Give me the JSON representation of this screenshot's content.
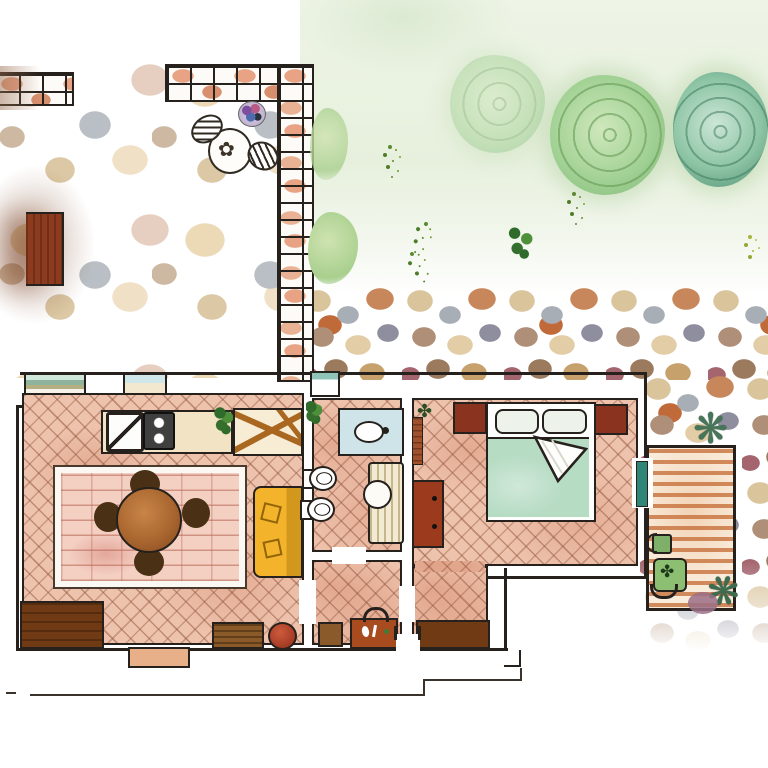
{
  "meta": {
    "title": "Watercolor floor plan of an apartment with garden, stone courtyard and wooden terrace",
    "type": "hand-painted illustration, no text in image",
    "canvas_px": {
      "width": 768,
      "height": 768
    }
  },
  "palette": {
    "paper": "#ffffff",
    "ink": "#26211c",
    "floor_terracotta": "#eec3ad",
    "floor_joint_line": "#92543c",
    "rug_pink": "#f4d0c3",
    "brick_wall_salmon": "#e8a284",
    "garden_wash_green": "#e7f0dd",
    "bush_green": "#a3d295",
    "bush_teal": "#8cc4a4",
    "bed_duvet_green": "#b7dcc4",
    "sofa_yellow": "#f3b32a",
    "wood_dark_brown": "#6f3a14",
    "wood_red_brown": "#9c3a1e",
    "deck_plank_orange": "#c86e38",
    "door_teal": "#2f8577",
    "basin_blue": "#cfe4e9",
    "counter_cream": "#f2e3c4",
    "stone_gray": "#a8aeb6",
    "stone_tan": "#d9c49c",
    "clay_pot_red": "#b5402a"
  },
  "scene": {
    "exterior": {
      "areas": [
        {
          "name": "garden-lawn",
          "position": "top-right"
        },
        {
          "name": "stone-path",
          "position": "center-right band"
        },
        {
          "name": "stone-courtyard",
          "position": "top-left"
        },
        {
          "name": "right-pebble-yard",
          "position": "around terrace"
        }
      ],
      "garden_plants": [
        {
          "name": "rose-bush-faint"
        },
        {
          "name": "rose-bush-large"
        },
        {
          "name": "rose-bush-teal"
        },
        {
          "name": "grass-tuft",
          "count": 5
        },
        {
          "name": "wall-climber-leaves",
          "count": 2
        }
      ],
      "walls": [
        {
          "name": "garden-wall-left-stub"
        },
        {
          "name": "garden-wall-top"
        },
        {
          "name": "garden-wall-right"
        }
      ],
      "courtyard_items": [
        {
          "name": "patio-table",
          "detail": "round, flower sketch on top"
        },
        {
          "name": "patio-chair",
          "count": 2,
          "detail": "hatched ovals"
        },
        {
          "name": "flower-pot",
          "detail": "purple-blue-pink"
        },
        {
          "name": "garden-bench",
          "detail": "red-brown, fades at left edge"
        }
      ]
    },
    "rooms": [
      {
        "name": "living-dining-room",
        "floor": "terracotta-herringbone",
        "items": [
          "window-bay",
          "window",
          "kitchen-counter",
          "kitchen-sink",
          "kitchen-stove",
          "potted-plant",
          "trestle-desk",
          "area-rug",
          "round-dining-table",
          "dining-chairs-x4",
          "yellow-sofa",
          "sideboard",
          "low-bench",
          "clay-pot",
          "door-step"
        ]
      },
      {
        "name": "bathroom",
        "floor": "terracotta-herringbone",
        "items": [
          "window",
          "potted-plant",
          "washbasin-counter",
          "toilet",
          "bidet",
          "shower-tub"
        ]
      },
      {
        "name": "hallway",
        "floor": "terracotta-herringbone",
        "items": [
          "stool",
          "luggage-chest"
        ]
      },
      {
        "name": "bedroom",
        "floor": "terracotta-herringbone",
        "items": [
          "double-bed",
          "pillows-x2",
          "green-duvet",
          "folded-sheet",
          "nightstand-left",
          "nightstand-right",
          "dresser",
          "radiator",
          "plant-mark",
          "storage-cabinet"
        ]
      },
      {
        "name": "terrace",
        "floor": "orange-deck-planks",
        "items": [
          "side-table",
          "green-chair",
          "agave-plant-top",
          "agave-plant-bottom"
        ]
      }
    ],
    "doors": [
      {
        "name": "door-living-hallway"
      },
      {
        "name": "door-bathroom-hallway"
      },
      {
        "name": "door-hallway-bedroom"
      },
      {
        "name": "main-entrance"
      },
      {
        "name": "door-bedroom-terrace",
        "color": "#2f8577"
      }
    ],
    "ground_marks": [
      {
        "name": "porch-outline-lines"
      },
      {
        "name": "entrance-step"
      }
    ]
  }
}
